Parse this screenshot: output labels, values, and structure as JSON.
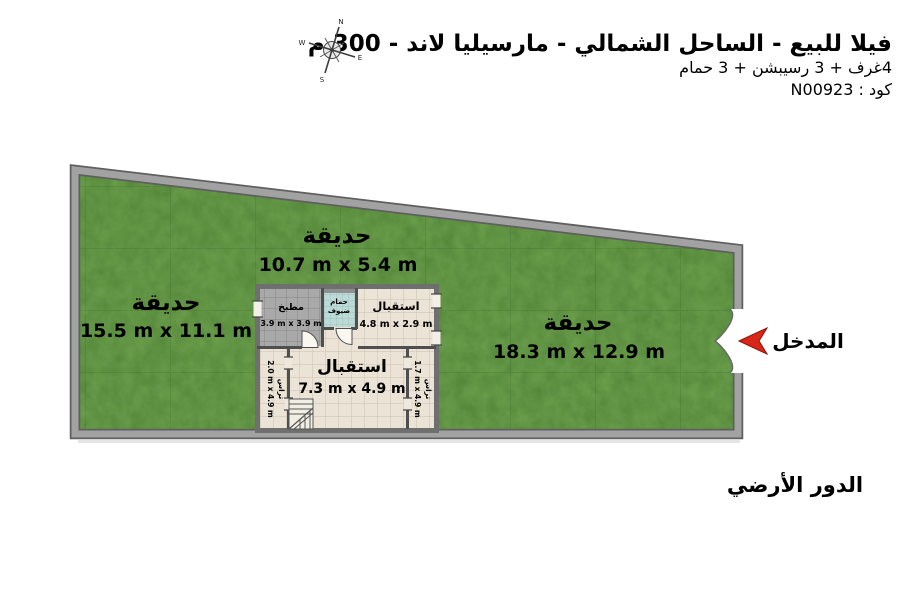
{
  "header": {
    "title": "فيلا للبيع - الساحل الشمالي - مارسيليا لاند - 300 م",
    "subtitle": "4غرف + 3 رسيبشن + 3 حمام",
    "code_line": "كود : N00923"
  },
  "compass": {
    "north": "N",
    "east": "E",
    "south": "S",
    "west": "W"
  },
  "plan": {
    "garden_left": {
      "name": "حديقة",
      "dims": "15.5 m x 11.1 m"
    },
    "garden_top": {
      "name": "حديقة",
      "dims": "10.7 m x 5.4 m"
    },
    "garden_right": {
      "name": "حديقة",
      "dims": "18.3 m x 12.9 m"
    },
    "kitchen": {
      "name": "مطبخ",
      "dims": "3.9 m x 3.9 m"
    },
    "guest_bathroom": {
      "name_line1": "حمام",
      "name_line2": "ضيوف"
    },
    "reception_small": {
      "name": "استقبال",
      "dims": "4.8 m x 2.9 m"
    },
    "reception_large": {
      "name": "استقبال",
      "dims": "7.3 m x 4.9 m"
    },
    "terrace_left": {
      "name": "تراس",
      "dims": "2.0 m x 4.9 m"
    },
    "terrace_right": {
      "name": "تراس",
      "dims": "1.7 m x 4.9 m"
    },
    "entrance_label": "المدخل",
    "floor_label": "الدور الأرضي"
  },
  "colors": {
    "grass_base": "#5f9342",
    "border_gray": "#a2a2a2",
    "border_edge": "#5f5f5f",
    "floor_beige": "#eae3d6",
    "kitchen_gray": "#a9a9a9",
    "bathroom_cyan": "#bcdad7",
    "wall_dark": "#4f4f4f",
    "entrance_arrow_red": "#d9261a"
  }
}
